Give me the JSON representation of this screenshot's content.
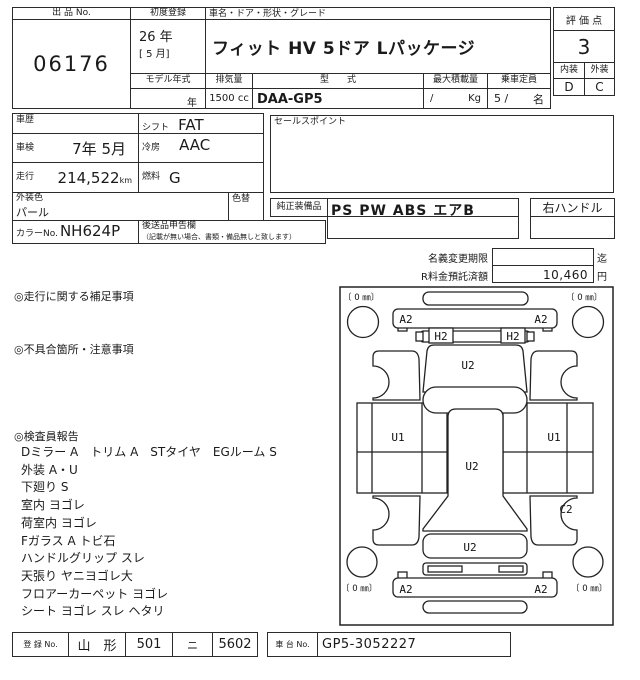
{
  "header": {
    "lot_label": "出 品 No.",
    "lot_no": "06176",
    "first_reg_label": "初度登録",
    "first_reg_line1": "26 年",
    "first_reg_line2": "[ 5 月]",
    "car_header": "車名・ドア・形状・グレード",
    "car_name": "フィット HV 5ドア  Lパッケージ",
    "model_year_label": "モデル年式",
    "model_year_value": "年",
    "displacement_label": "排気量",
    "displacement_value": "1500 cc",
    "model_code_label": "型　　式",
    "model_code_value": "DAA-GP5",
    "max_load_label": "最大積載量",
    "max_load_value": "/",
    "max_load_unit": "Kg",
    "capacity_label": "乗車定員",
    "capacity_value": "5 /",
    "capacity_unit": "名",
    "score_label": "評 価 点",
    "score_value": "3",
    "interior_label": "内装",
    "exterior_label": "外装",
    "interior_grade": "D",
    "exterior_grade": "C"
  },
  "details": {
    "history_label": "車歴",
    "shift_label": "シフト",
    "shift_value": "FAT",
    "inspection_label": "車検",
    "inspection_value": "7年 5月",
    "ac_label": "冷房",
    "ac_value": "AAC",
    "mileage_label": "走行",
    "mileage_value": "214,522",
    "mileage_unit": "km",
    "fuel_label": "燃料",
    "fuel_value": "G",
    "body_color_label": "外装色",
    "body_color_value": "パール",
    "repaint_label": "色替",
    "color_no_label": "カラーNo.",
    "color_no_value": "NH624P",
    "later_items_label": "後送品申告欄",
    "later_items_note": "（記載が無い場合、書類・備品無しと致します）",
    "sales_point_label": "セールスポイント",
    "equipment_label": "純正装備品",
    "equipment_value": "PS PW ABS エアB",
    "handle_value": "右ハンドル"
  },
  "fees": {
    "name_change_label": "名義変更期限",
    "name_change_value": "",
    "name_change_unit": "迄",
    "recycle_label": "R料金預託済額",
    "recycle_value": "10,460",
    "recycle_unit": "円"
  },
  "notes": {
    "driving_title": "◎走行に関する補足事項",
    "defects_title": "◎不具合箇所・注意事項",
    "inspector_title": "◎検査員報告",
    "inspector_lines": [
      "Dミラー A　トリム A　STタイヤ　EGルーム S",
      "外装 A・U",
      "下廻り S",
      "室内 ヨゴレ",
      "荷室内 ヨゴレ",
      "Fガラス A トビ石",
      "ハンドルグリップ スレ",
      "天張り ヤニヨゴレ大",
      "フロアーカーペット ヨゴレ",
      "シート ヨゴレ スレ ヘタリ"
    ]
  },
  "footer": {
    "reg_label": "登 録 No.",
    "reg_area": "山　形",
    "reg_class": "501",
    "reg_kana": "ニ",
    "reg_number": "5602",
    "chassis_label": "車 台 No.",
    "chassis_value": "GP5-3052227"
  },
  "diagram": {
    "tire_labels": [
      {
        "position": "front_left",
        "text": "〔 0 ㎜〕",
        "x": 343,
        "y": 300
      },
      {
        "position": "front_right",
        "text": "〔 0 ㎜〕",
        "x": 566,
        "y": 300
      },
      {
        "position": "rear_left",
        "text": "〔 0 ㎜〕",
        "x": 341,
        "y": 591
      },
      {
        "position": "rear_right",
        "text": "〔 0 ㎜〕",
        "x": 571,
        "y": 591
      }
    ],
    "damage_labels": [
      {
        "part": "front_bumper_left",
        "text": "A2",
        "x": 406,
        "y": 323
      },
      {
        "part": "front_bumper_right",
        "text": "A2",
        "x": 541,
        "y": 323
      },
      {
        "part": "headlight_left",
        "text": "H2",
        "x": 441,
        "y": 340
      },
      {
        "part": "headlight_right",
        "text": "H2",
        "x": 513,
        "y": 340
      },
      {
        "part": "hood",
        "text": "U2",
        "x": 468,
        "y": 369
      },
      {
        "part": "front_door_left",
        "text": "U1",
        "x": 398,
        "y": 441
      },
      {
        "part": "front_door_right",
        "text": "U1",
        "x": 554,
        "y": 441
      },
      {
        "part": "roof",
        "text": "U2",
        "x": 472,
        "y": 470
      },
      {
        "part": "rear_quarter_right",
        "text": "C2",
        "x": 566,
        "y": 513
      },
      {
        "part": "tailgate",
        "text": "U2",
        "x": 470,
        "y": 551
      },
      {
        "part": "rear_bumper_left",
        "text": "A2",
        "x": 406,
        "y": 593
      },
      {
        "part": "rear_bumper_right",
        "text": "A2",
        "x": 541,
        "y": 593
      }
    ]
  },
  "colors": {
    "line": "#2b2b2b",
    "text": "#1a1a1a",
    "bg": "#ffffff"
  }
}
